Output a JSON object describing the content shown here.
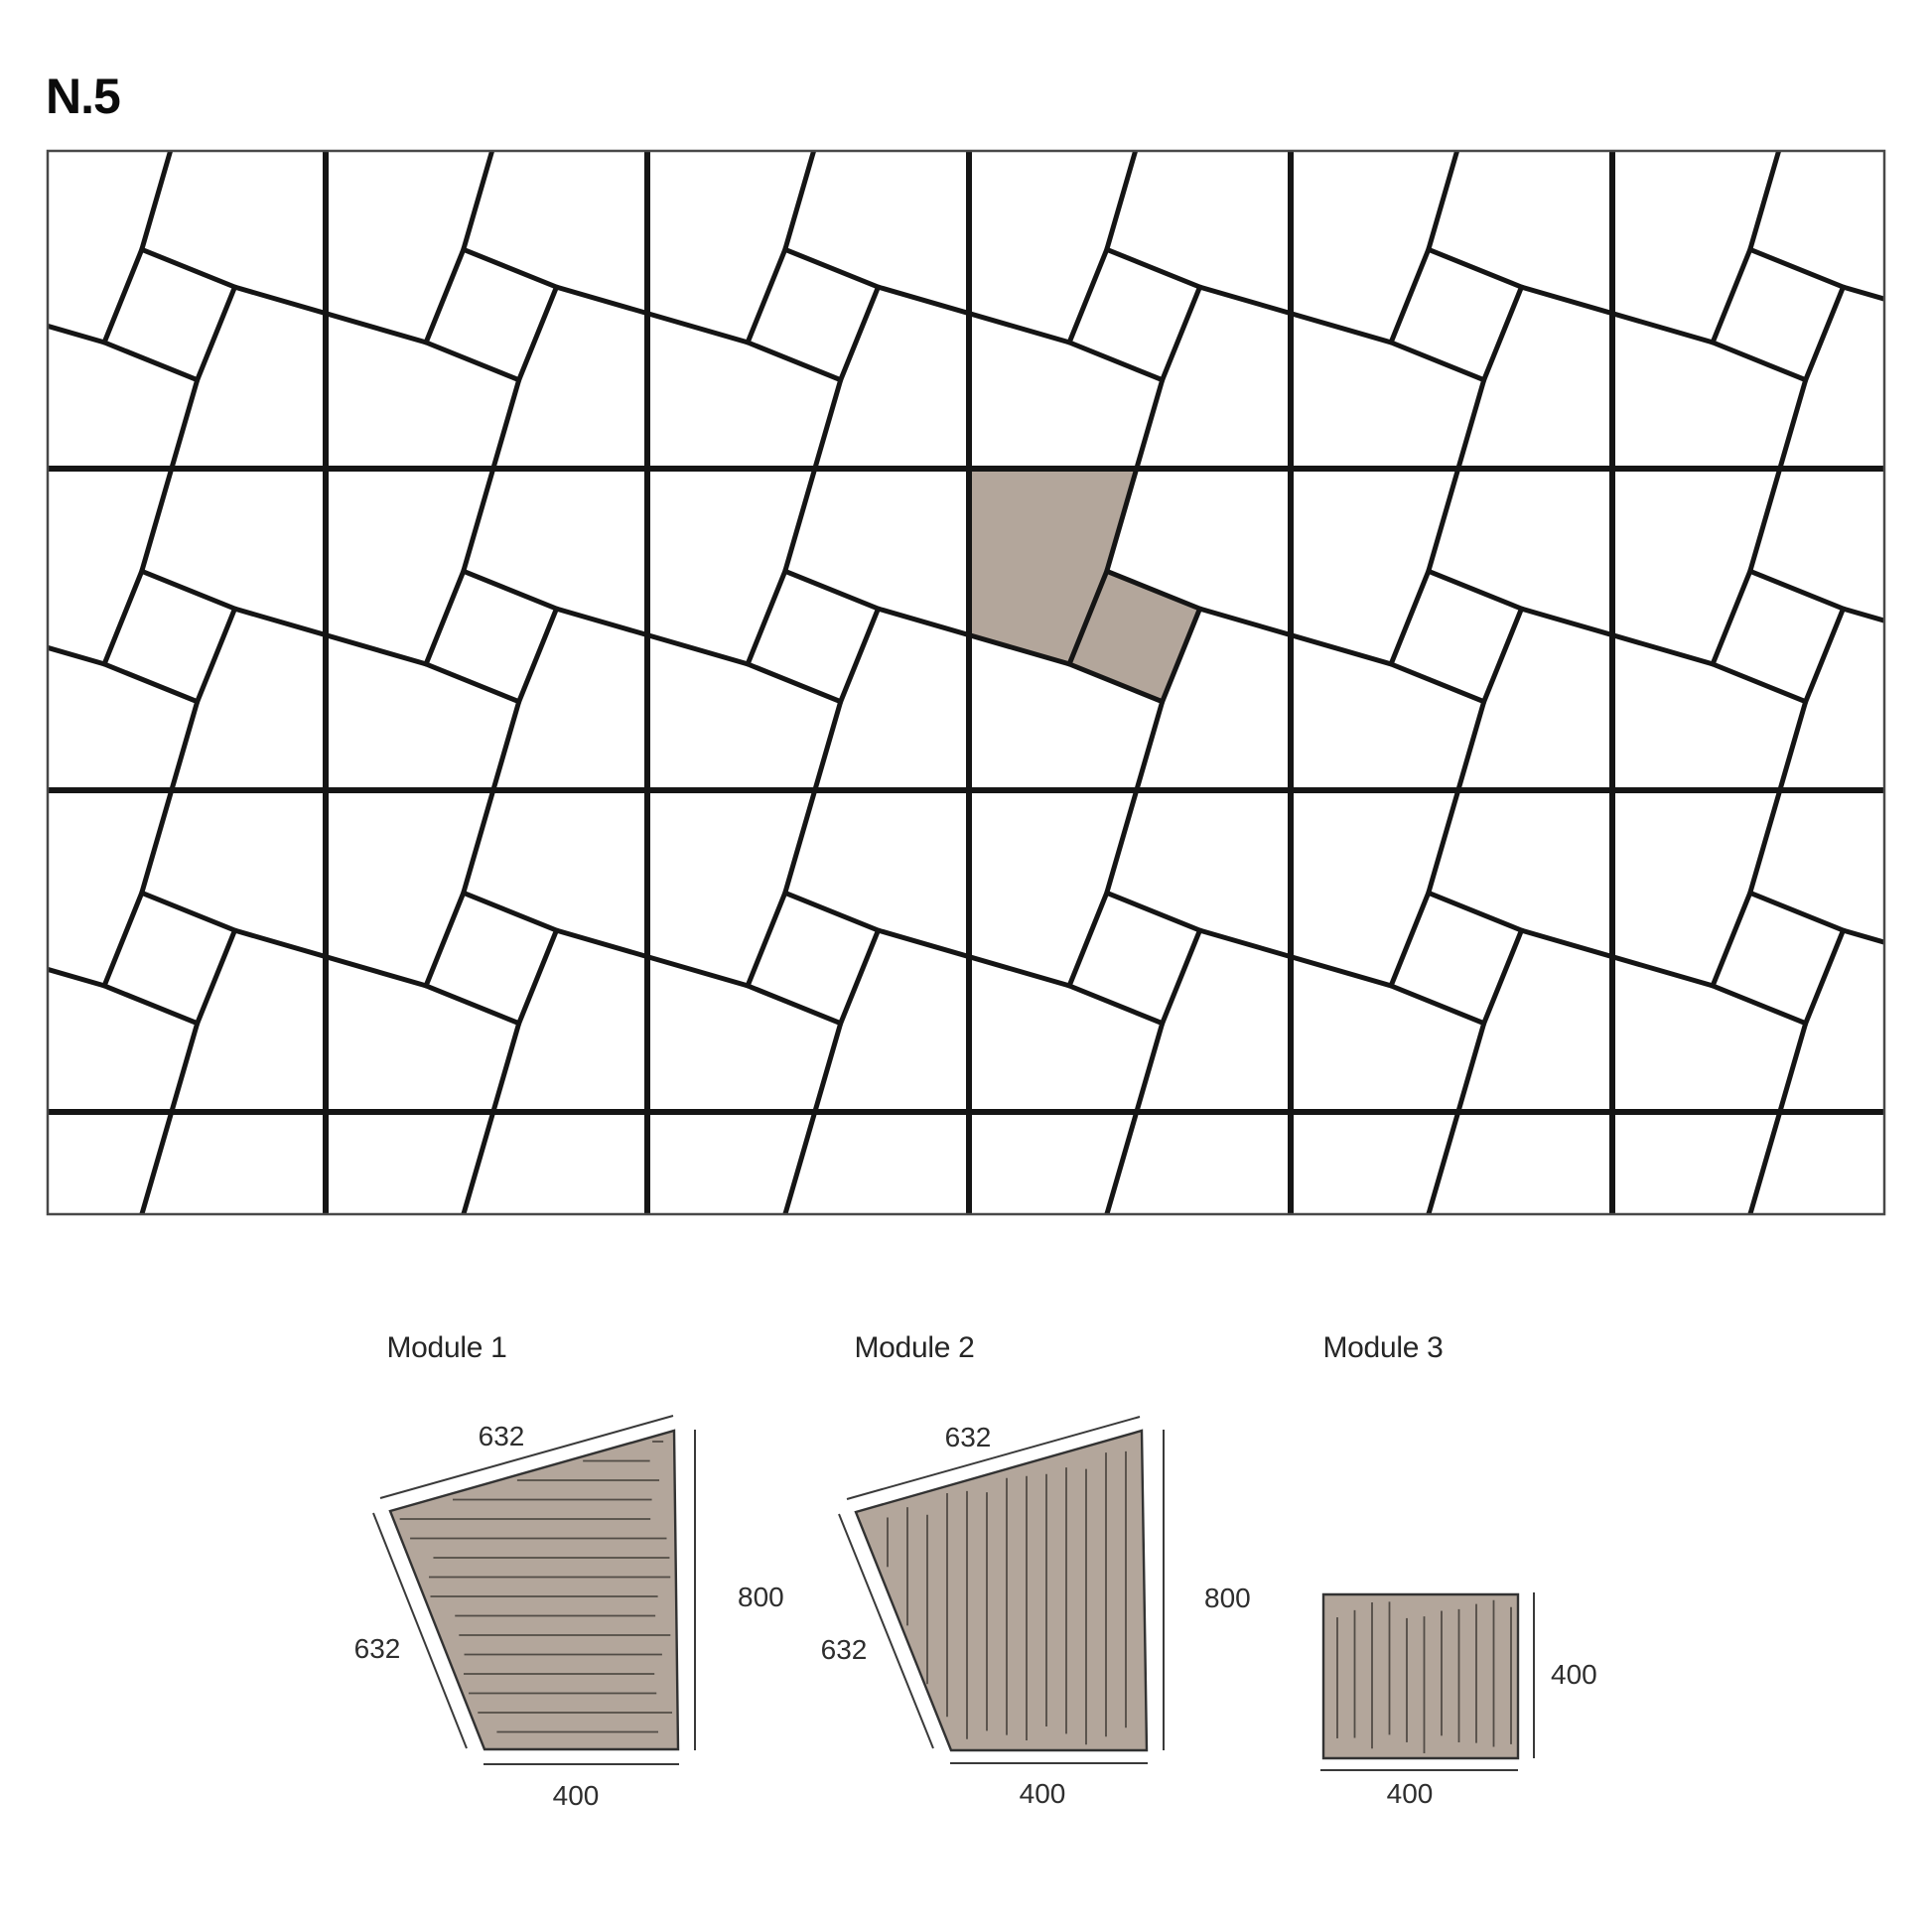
{
  "page": {
    "code": "N.5",
    "background": "#ffffff"
  },
  "pattern_board": {
    "background": "#ffffff",
    "tile_line_color": "#151515",
    "grid_line_color": "#151515",
    "frame_color": "#484848",
    "highlight_color": "#b3a69b",
    "highlighted_pieces": [
      "Module 1",
      "Module 3"
    ]
  },
  "modules": [
    {
      "title": "Module 1",
      "hatch": "horizontal",
      "fill": "#b3a69b",
      "outline": "#323232",
      "hatch_color": "#524c46",
      "dims": {
        "top": "632",
        "left": "632",
        "right": "800",
        "bottom": "400"
      }
    },
    {
      "title": "Module 2",
      "hatch": "vertical",
      "fill": "#b3a69b",
      "outline": "#323232",
      "hatch_color": "#524c46",
      "dims": {
        "top": "632",
        "left": "632",
        "right": "800",
        "bottom": "400"
      }
    },
    {
      "title": "Module 3",
      "hatch": "vertical",
      "fill": "#b3a69b",
      "outline": "#323232",
      "hatch_color": "#524c46",
      "dims": {
        "right": "400",
        "bottom": "400"
      }
    }
  ]
}
